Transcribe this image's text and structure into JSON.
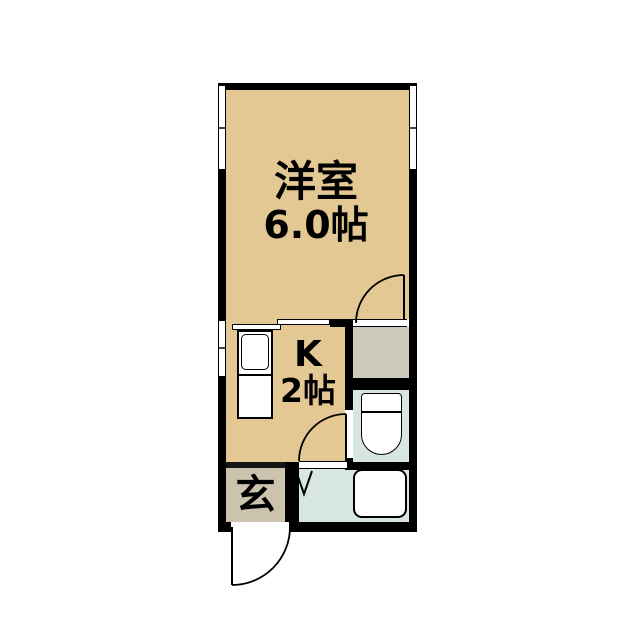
{
  "floorplan": {
    "title": "1K apartment floor plan",
    "rooms": {
      "western_room": {
        "name": "洋室",
        "size": "6.0帖"
      },
      "kitchen": {
        "name": "K",
        "size": "2帖"
      },
      "entrance": {
        "name": "玄"
      }
    },
    "fixtures": [
      "kitchen-sink",
      "toilet",
      "bathtub"
    ],
    "palette": {
      "room_tan": "#E4C893",
      "entrance_gray": "#CBC3AD",
      "closet_gray": "#CDC9BD",
      "wet_area_blue": "#D7E6E3",
      "wall_black": "#000000",
      "background": "#FFFFFF"
    }
  }
}
